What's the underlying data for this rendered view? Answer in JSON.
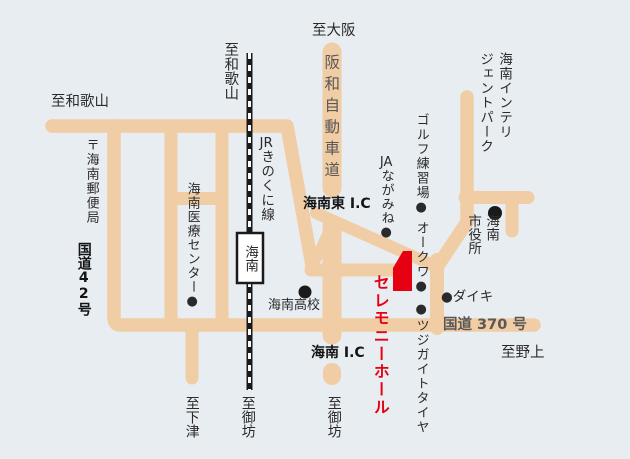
{
  "map_title": "セレモニーホール案内図",
  "colors": {
    "background": "#e8edf2",
    "road": "#f0cda4",
    "railway": "#1a1a1a",
    "accent_red": "#e50012",
    "muted_text": "#5a5757"
  },
  "destinations": {
    "to_osaka": "至大阪",
    "to_wakayama_rail": "至和歌山",
    "to_wakayama_road": "至和歌山",
    "to_nogami": "至野上",
    "to_shimotsu": "至下津",
    "to_gobo_rail": "至御坊",
    "to_gobo_road": "至御坊"
  },
  "roads": {
    "hanwa_expressway": "阪和自動車道",
    "route_42": "国道42号",
    "route_370": "国道 370 号",
    "kainan_east_ic": "海南東 I.C",
    "kainan_ic": "海南 I.C"
  },
  "railway": {
    "line_prefix": "JR",
    "line_suffix": "きのくに線",
    "station": "海南"
  },
  "destination_hall": {
    "name": "セレモニーホール"
  },
  "places": {
    "post_office": "〒海南郵便局",
    "medical_center": "海南医療センター●",
    "kainan_high_school": "海南高校",
    "ja_prefix": "JA",
    "ja_suffix": "ながみね●",
    "golf_range": "ゴルフ練習場●",
    "okuwa": "オークワ●",
    "tsujigaito_tire": "●ツジガイトタイヤ",
    "daiki": "●ダイキ",
    "city_hall_line1": "海南",
    "city_hall_line2": "市役所",
    "intelligent_park_line1": "海南インテリ",
    "intelligent_park_line2": "ジェントパーク"
  }
}
